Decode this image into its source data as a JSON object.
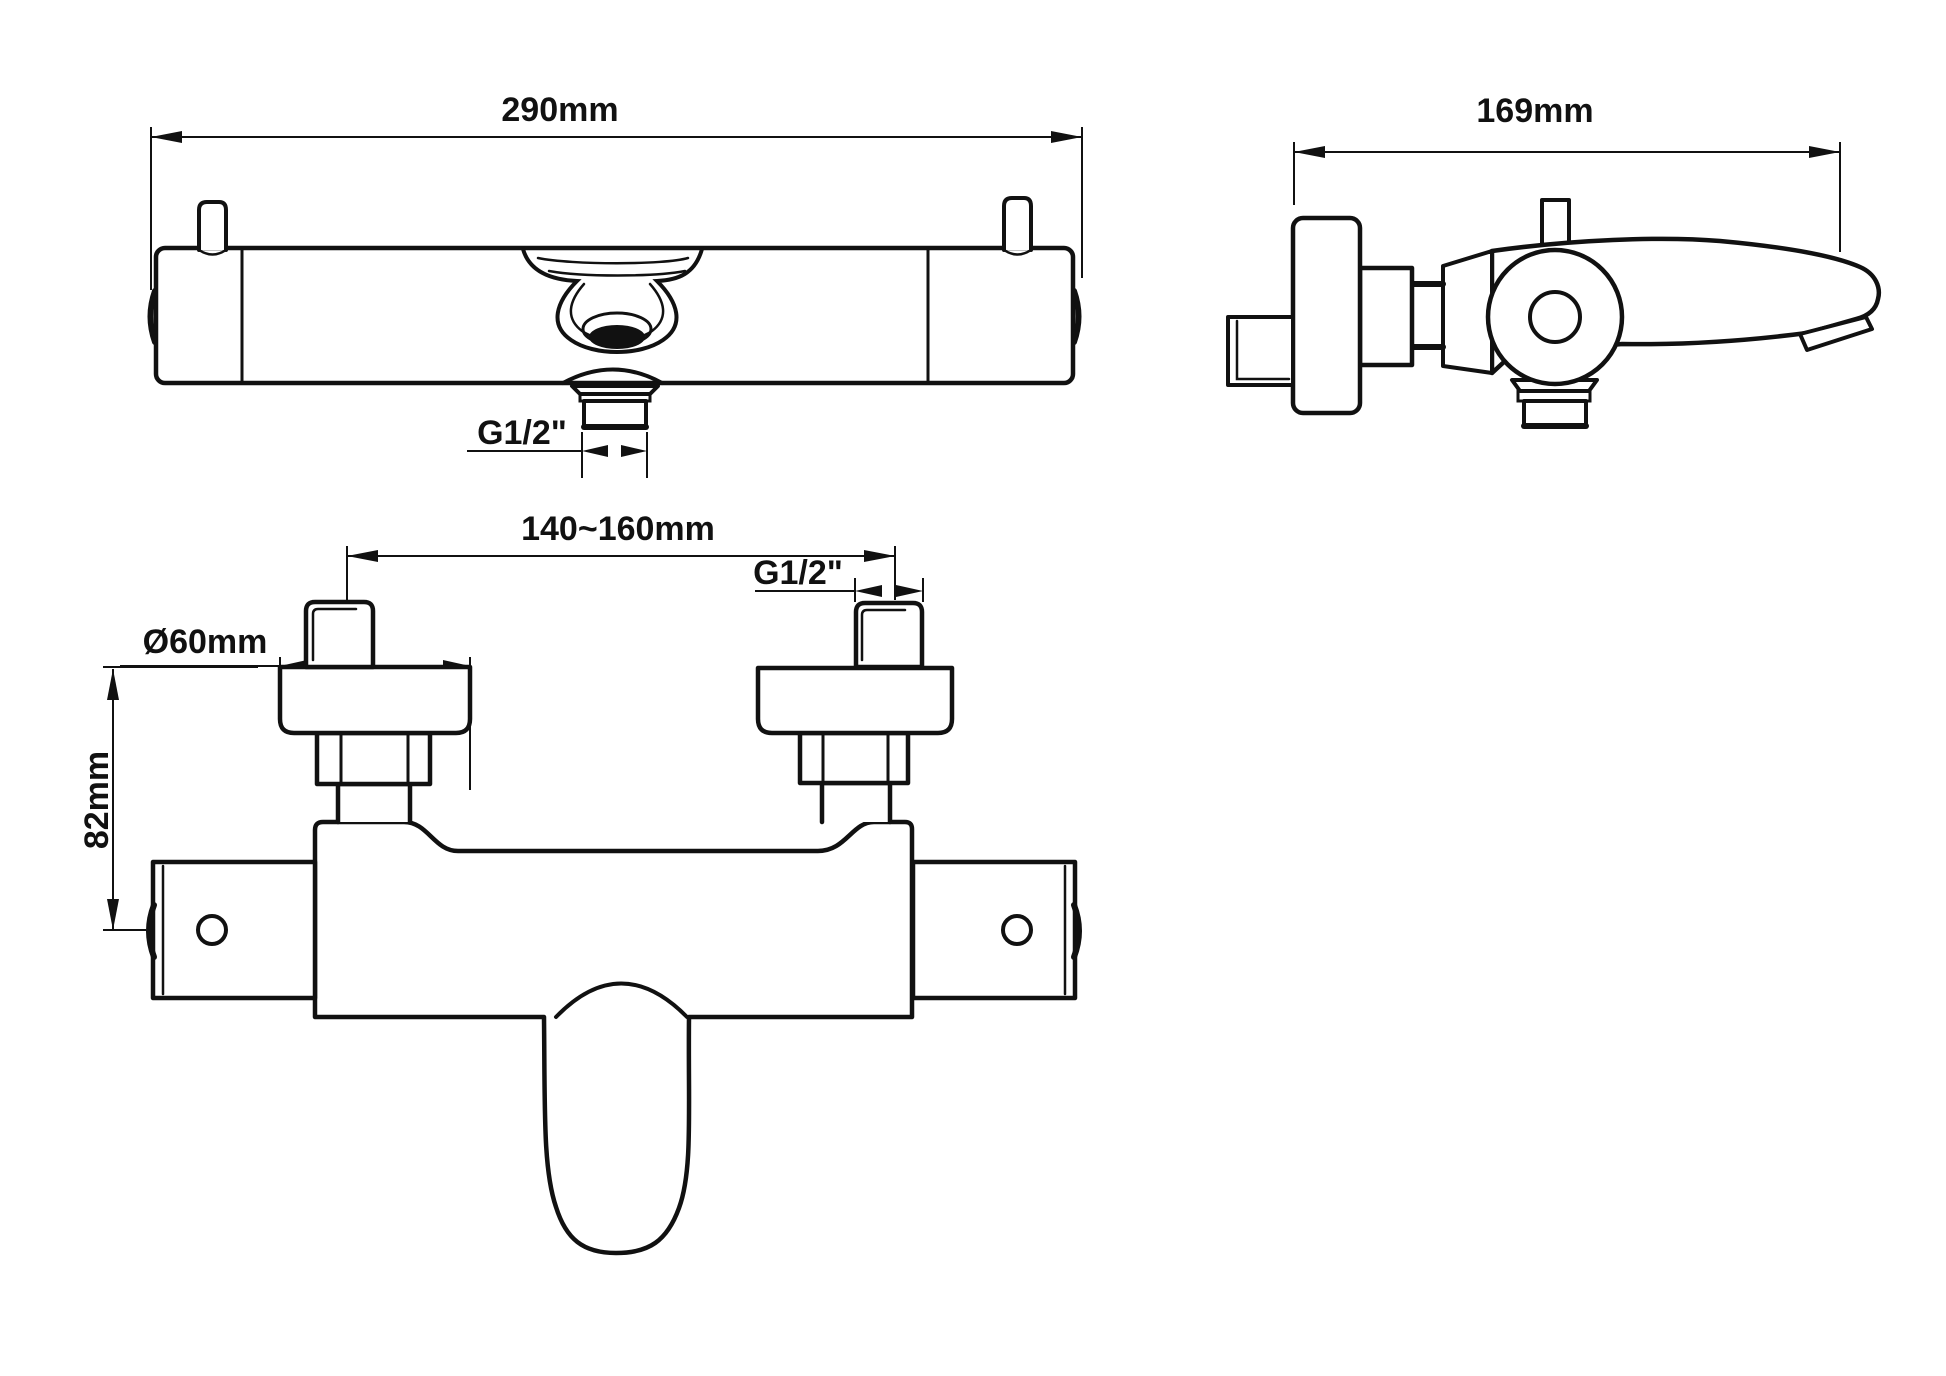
{
  "colors": {
    "background": "#ffffff",
    "line": "#111111"
  },
  "views": {
    "top": {
      "labels": {
        "width": "290mm",
        "outlet_thread": "G1/2\""
      }
    },
    "side": {
      "labels": {
        "depth": "169mm"
      }
    },
    "front": {
      "labels": {
        "hole_spacing": "140~160mm",
        "escutcheon_diameter": "Ø60mm",
        "inlet_thread": "G1/2\"",
        "mount_height": "82mm"
      }
    }
  }
}
